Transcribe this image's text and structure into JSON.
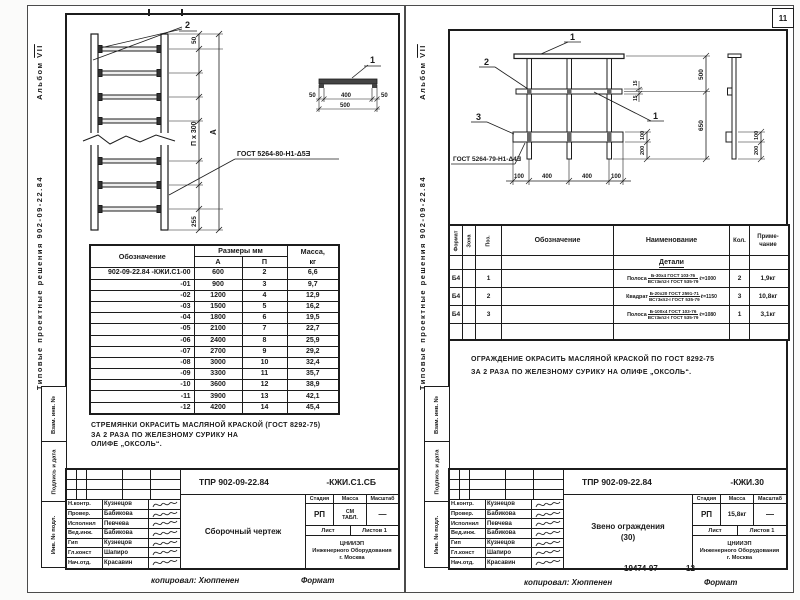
{
  "page_number": "11",
  "stamps": {
    "s1": "Взам. инв. №",
    "s2": "Подпись и дата",
    "s3": "Инв. № подл."
  },
  "left_page": {
    "margin": {
      "series": "Типовые проектные решения  902-09-22.84",
      "album_word": "Альбом",
      "album_num": "VII"
    },
    "drawing": {
      "callout_1": "1",
      "callout_2": "2",
      "dim_top": "50",
      "dim_chain": "П х 300",
      "dim_overall": "А",
      "dim_bottom": "255",
      "tv_50l": "50",
      "tv_400": "400",
      "tv_50r": "50",
      "tv_500": "500",
      "weld": "ГОСТ 5264-80-Н1-Δ5Ǝ"
    },
    "table": {
      "h_designation": "Обозначение",
      "h_sizes": "Размеры мм",
      "h_a": "А",
      "h_p": "П",
      "h_mass1": "Масса,",
      "h_mass2": "кг",
      "rows": [
        [
          "902-09-22.84 -КЖИ.С1-00",
          "600",
          "2",
          "6,6"
        ],
        [
          "-01",
          "900",
          "3",
          "9,7"
        ],
        [
          "-02",
          "1200",
          "4",
          "12,9"
        ],
        [
          "-03",
          "1500",
          "5",
          "16,2"
        ],
        [
          "-04",
          "1800",
          "6",
          "19,5"
        ],
        [
          "-05",
          "2100",
          "7",
          "22,7"
        ],
        [
          "-06",
          "2400",
          "8",
          "25,9"
        ],
        [
          "-07",
          "2700",
          "9",
          "29,2"
        ],
        [
          "-08",
          "3000",
          "10",
          "32,4"
        ],
        [
          "-09",
          "3300",
          "11",
          "35,7"
        ],
        [
          "-10",
          "3600",
          "12",
          "38,9"
        ],
        [
          "-11",
          "3900",
          "13",
          "42,1"
        ],
        [
          "-12",
          "4200",
          "14",
          "45,4"
        ]
      ]
    },
    "note_line1": "СТРЕМЯНКИ   ОКРАСИТЬ  МАСЛЯНОЙ   КРАСКОЙ (ГОСТ 8292-75)",
    "note_line2": "ЗА 2 РАЗА    ПО   ЖЕЛЕЗНОМУ   СУРИКУ   НА",
    "note_line3": "ОЛИФЕ „ОКСОЛЬ“.",
    "title_block": {
      "doc": "ТПР  902-09-22.84",
      "code": "-КЖИ.С1.СБ",
      "signers": [
        [
          "Н.контр.",
          "Кузнецов"
        ],
        [
          "Провер.",
          "Бабикова"
        ],
        [
          "Исполнил",
          "Певчева"
        ],
        [
          "Вед.инж.",
          "Бабикова"
        ],
        [
          "Гип",
          "Кузнецов"
        ],
        [
          "Гл.конст",
          "Шапиро"
        ],
        [
          "Нач.отд.",
          "Красавин"
        ]
      ],
      "title": "Сборочный чертеж",
      "h_stage": "Стадия",
      "h_mass": "Масса",
      "h_scale": "Масштаб",
      "stage": "РП",
      "mass1": "СМ",
      "mass2": "ТАБЛ.",
      "scale": "—",
      "sheet": "Лист",
      "sheets": "Листов 1",
      "org1": "ЦНИИЭП",
      "org2": "Инженерного Оборудования",
      "org3": "г. Москва"
    },
    "footer_copied": "копировал: Хюппенен",
    "footer_format": "Формат"
  },
  "right_page": {
    "margin": {
      "series": "Типовые проектные решения  902-09-22.84",
      "album_word": "Альбом",
      "album_num": "VII"
    },
    "drawing": {
      "callout_1a": "1",
      "callout_2": "2",
      "callout_3": "3",
      "callout_1b": "1",
      "dim_500": "500",
      "dim_650": "650",
      "dim_15a": "15",
      "dim_15b": "15",
      "dim_100a": "100",
      "dim_200a": "200",
      "b_100l": "100",
      "b_400a": "400",
      "b_400b": "400",
      "b_100r": "100",
      "sv_100": "100",
      "sv_200": "200",
      "weld": "ГОСТ 5264-79-Н1-Δ4Ǝ"
    },
    "spec": {
      "h_format": "Формат",
      "h_zone": "Зона",
      "h_pos": "Поз.",
      "h_desig": "Обозначение",
      "h_name": "Наименование",
      "h_qty": "Кол.",
      "h_note1": "Приме-",
      "h_note2": "чание",
      "section": "Детали",
      "rows": [
        {
          "fmt": "Б4",
          "pos": "1",
          "prefix": "Полоса",
          "top": "Б-30х4 ГОСТ 103-76",
          "bot": "ВСт3кп2-I ГОСТ 535-79",
          "len": "ℓ=1000",
          "qty": "2",
          "note": "1,9кг"
        },
        {
          "fmt": "Б4",
          "pos": "2",
          "prefix": "Квадрат",
          "top": "Б-20х20 ГОСТ 2591-71",
          "bot": "ВСт3кп2-I ГОСТ 535-79",
          "len": "ℓ=1150",
          "qty": "3",
          "note": "10,8кг"
        },
        {
          "fmt": "Б4",
          "pos": "3",
          "prefix": "Полоса",
          "top": "Б-100х4 ГОСТ 103-76",
          "bot": "ВСт3кп2-I ГОСТ 535-79",
          "len": "ℓ=1080",
          "qty": "1",
          "note": "3,1кг"
        }
      ]
    },
    "note_line1": "ОГРАЖДЕНИЕ    ОКРАСИТЬ   МАСЛЯНОЙ  КРАСКОЙ  ПО  ГОСТ 8292-75",
    "note_line2": "ЗА   2  РАЗА   ПО  ЖЕЛЕЗНОМУ   СУРИКУ   НА  ОЛИФЕ „ОКСОЛЬ“.",
    "title_block": {
      "doc": "ТПР  902-09-22.84",
      "code": "-КЖИ.30",
      "signers": [
        [
          "Н.контр.",
          "Кузнецов"
        ],
        [
          "Провер.",
          "Бабикова"
        ],
        [
          "Исполнил",
          "Певчева"
        ],
        [
          "Вед.инж.",
          "Бабикова"
        ],
        [
          "Гип",
          "Кузнецов"
        ],
        [
          "Гл.конст",
          "Шапиро"
        ],
        [
          "Нач.отд.",
          "Красавин"
        ]
      ],
      "title1": "Звено ограждения",
      "title2": "(30)",
      "h_stage": "Стадия",
      "h_mass": "Масса",
      "h_scale": "Масштаб",
      "stage": "РП",
      "mass": "15,8кг",
      "scale": "—",
      "sheet": "Лист",
      "sheets": "Листов 1",
      "org1": "ЦНИИЭП",
      "org2": "Инженерного Оборудования",
      "org3": "г. Москва"
    },
    "stamp_num": "19474-97",
    "sheet_num": "12",
    "footer_copied": "копировал: Хюппенен",
    "footer_format": "Формат"
  }
}
